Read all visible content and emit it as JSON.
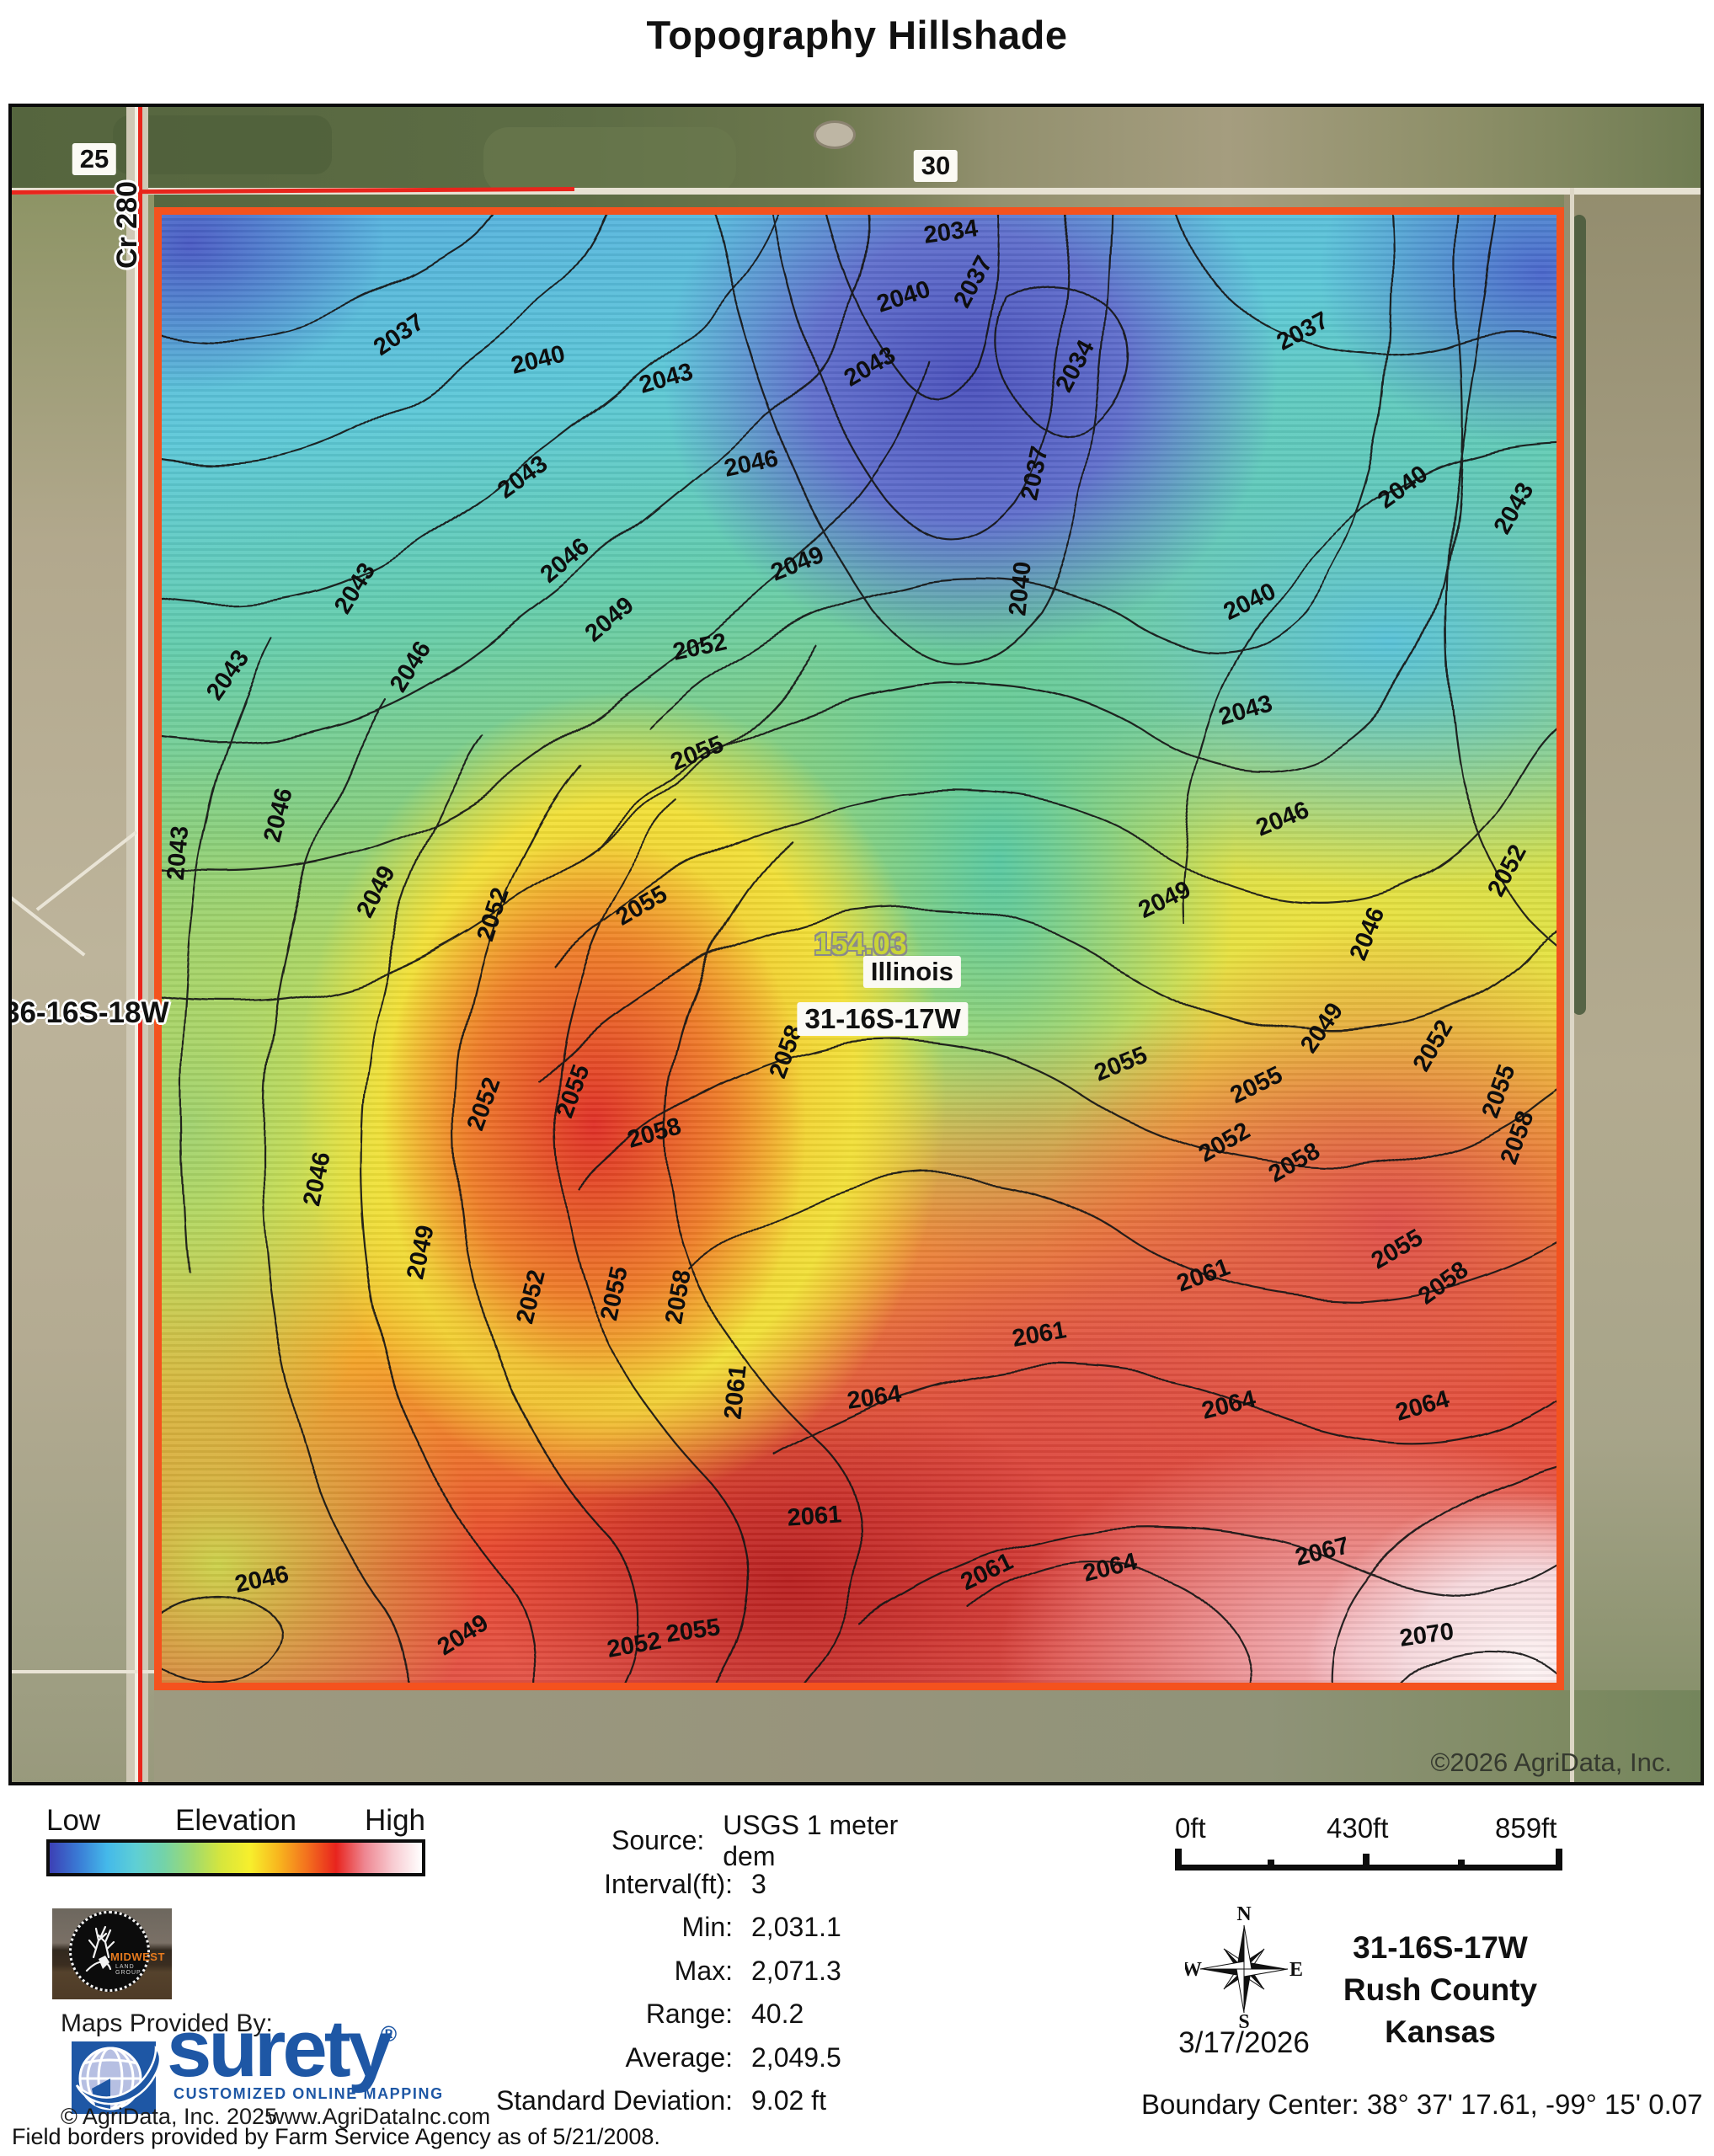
{
  "title": "Topography Hillshade",
  "map": {
    "road_labels": {
      "left_section": "25",
      "top_section": "30",
      "road_name": "Cr 280"
    },
    "section_label_left": "36-16S-18W",
    "parcel": {
      "acreage": "154.03",
      "name": "Illinois",
      "section": "31-16S-17W"
    },
    "copyright": "©2026 AgriData, Inc.",
    "boundary_color": "#f4521e",
    "section_line_color": "#e8251c",
    "contour_labels": [
      {
        "v": "2034",
        "x": 56.6,
        "y": 1.2,
        "r": -8
      },
      {
        "v": "2037",
        "x": 58.2,
        "y": 4.6,
        "r": -62
      },
      {
        "v": "2040",
        "x": 53.2,
        "y": 5.6,
        "r": -18
      },
      {
        "v": "2034",
        "x": 65.5,
        "y": 10.3,
        "r": -62
      },
      {
        "v": "2037",
        "x": 81.8,
        "y": 8.0,
        "r": -28
      },
      {
        "v": "2037",
        "x": 17.0,
        "y": 8.2,
        "r": -34
      },
      {
        "v": "2040",
        "x": 27.0,
        "y": 9.9,
        "r": -14
      },
      {
        "v": "2043",
        "x": 36.2,
        "y": 11.2,
        "r": -16
      },
      {
        "v": "2043",
        "x": 50.8,
        "y": 10.4,
        "r": -30
      },
      {
        "v": "2040",
        "x": 89.0,
        "y": 18.6,
        "r": -36
      },
      {
        "v": "2043",
        "x": 97.0,
        "y": 20.0,
        "r": -60
      },
      {
        "v": "2037",
        "x": 62.6,
        "y": 17.6,
        "r": -78
      },
      {
        "v": "2040",
        "x": 61.6,
        "y": 25.5,
        "r": -84
      },
      {
        "v": "2043",
        "x": 25.9,
        "y": 17.9,
        "r": -36
      },
      {
        "v": "2046",
        "x": 42.3,
        "y": 17.0,
        "r": -12
      },
      {
        "v": "2043",
        "x": 13.9,
        "y": 25.5,
        "r": -58
      },
      {
        "v": "2046",
        "x": 17.9,
        "y": 30.8,
        "r": -58
      },
      {
        "v": "2046",
        "x": 28.9,
        "y": 23.6,
        "r": -40
      },
      {
        "v": "2049",
        "x": 32.1,
        "y": 27.6,
        "r": -40
      },
      {
        "v": "2049",
        "x": 45.6,
        "y": 23.8,
        "r": -22
      },
      {
        "v": "2052",
        "x": 38.6,
        "y": 29.5,
        "r": -12
      },
      {
        "v": "2040",
        "x": 78.0,
        "y": 26.4,
        "r": -26
      },
      {
        "v": "2043",
        "x": 77.7,
        "y": 33.8,
        "r": -16
      },
      {
        "v": "2046",
        "x": 80.4,
        "y": 41.2,
        "r": -22
      },
      {
        "v": "2049",
        "x": 71.9,
        "y": 46.7,
        "r": -26
      },
      {
        "v": "2046",
        "x": 86.5,
        "y": 49.0,
        "r": -68
      },
      {
        "v": "2049",
        "x": 83.2,
        "y": 55.4,
        "r": -55
      },
      {
        "v": "2052",
        "x": 91.2,
        "y": 56.6,
        "r": -60
      },
      {
        "v": "2052",
        "x": 96.5,
        "y": 44.7,
        "r": -62
      },
      {
        "v": "2055",
        "x": 78.5,
        "y": 59.3,
        "r": -26
      },
      {
        "v": "2055",
        "x": 68.8,
        "y": 57.9,
        "r": -22
      },
      {
        "v": "2052",
        "x": 76.2,
        "y": 63.2,
        "r": -30
      },
      {
        "v": "2055",
        "x": 95.9,
        "y": 59.7,
        "r": -70
      },
      {
        "v": "2058",
        "x": 97.2,
        "y": 62.9,
        "r": -70
      },
      {
        "v": "2058",
        "x": 81.2,
        "y": 64.6,
        "r": -30
      },
      {
        "v": "2058",
        "x": 91.9,
        "y": 72.8,
        "r": -36
      },
      {
        "v": "2055",
        "x": 88.6,
        "y": 70.5,
        "r": -30
      },
      {
        "v": "2061",
        "x": 74.7,
        "y": 72.3,
        "r": -20
      },
      {
        "v": "2064",
        "x": 76.5,
        "y": 81.1,
        "r": -14
      },
      {
        "v": "2064",
        "x": 90.4,
        "y": 81.2,
        "r": -16
      },
      {
        "v": "2061",
        "x": 62.9,
        "y": 76.3,
        "r": -10
      },
      {
        "v": "2064",
        "x": 51.1,
        "y": 80.6,
        "r": -8
      },
      {
        "v": "2061",
        "x": 46.8,
        "y": 88.7,
        "r": -4
      },
      {
        "v": "2061",
        "x": 59.2,
        "y": 92.5,
        "r": -26
      },
      {
        "v": "2064",
        "x": 68.0,
        "y": 92.2,
        "r": -14
      },
      {
        "v": "2067",
        "x": 83.2,
        "y": 91.1,
        "r": -14
      },
      {
        "v": "2070",
        "x": 90.7,
        "y": 96.8,
        "r": -8
      },
      {
        "v": "2055",
        "x": 38.1,
        "y": 96.5,
        "r": -8
      },
      {
        "v": "2052",
        "x": 33.9,
        "y": 97.5,
        "r": -10
      },
      {
        "v": "2049",
        "x": 21.6,
        "y": 96.8,
        "r": -32
      },
      {
        "v": "2046",
        "x": 7.2,
        "y": 93.0,
        "r": -12
      },
      {
        "v": "2052",
        "x": 26.5,
        "y": 73.7,
        "r": -76
      },
      {
        "v": "2055",
        "x": 32.5,
        "y": 73.5,
        "r": -78
      },
      {
        "v": "2058",
        "x": 37.1,
        "y": 73.7,
        "r": -80
      },
      {
        "v": "2061",
        "x": 41.2,
        "y": 80.2,
        "r": -84
      },
      {
        "v": "2052",
        "x": 23.8,
        "y": 47.7,
        "r": -72
      },
      {
        "v": "2055",
        "x": 34.4,
        "y": 47.1,
        "r": -30
      },
      {
        "v": "2055",
        "x": 38.4,
        "y": 36.7,
        "r": -22
      },
      {
        "v": "2058",
        "x": 44.8,
        "y": 57.0,
        "r": -70
      },
      {
        "v": "2058",
        "x": 35.3,
        "y": 62.6,
        "r": -16
      },
      {
        "v": "2055",
        "x": 29.5,
        "y": 59.7,
        "r": -70
      },
      {
        "v": "2052",
        "x": 23.1,
        "y": 60.6,
        "r": -70
      },
      {
        "v": "2049",
        "x": 15.4,
        "y": 46.1,
        "r": -62
      },
      {
        "v": "2046",
        "x": 8.4,
        "y": 40.9,
        "r": -76
      },
      {
        "v": "2043",
        "x": 1.2,
        "y": 43.5,
        "r": -85
      },
      {
        "v": "2043",
        "x": 4.8,
        "y": 31.4,
        "r": -55
      },
      {
        "v": "2049",
        "x": 18.6,
        "y": 70.7,
        "r": -78
      },
      {
        "v": "2046",
        "x": 11.2,
        "y": 65.7,
        "r": -78
      }
    ]
  },
  "legend": {
    "low": "Low",
    "title": "Elevation",
    "high": "High",
    "gradient": [
      "#3c40b5",
      "#3a7bd5",
      "#44b9ea",
      "#5ecfd5",
      "#74d3a8",
      "#a0da6e",
      "#d7e63c",
      "#f7ef2c",
      "#f8b51e",
      "#f3701e",
      "#e8241e",
      "#ee8691",
      "#f8ccd2",
      "#ffffff"
    ]
  },
  "stats": {
    "rows": [
      {
        "label": "Source:",
        "value": "USGS 1 meter dem"
      },
      {
        "label": "Interval(ft):",
        "value": "3"
      },
      {
        "label": "Min:",
        "value": "2,031.1"
      },
      {
        "label": "Max:",
        "value": "2,071.3"
      },
      {
        "label": "Range:",
        "value": "40.2"
      },
      {
        "label": "Average:",
        "value": "2,049.5"
      },
      {
        "label": "Standard Deviation:",
        "value": "9.02 ft"
      }
    ]
  },
  "scalebar": {
    "labels": [
      "0ft",
      "430ft",
      "859ft"
    ]
  },
  "compass": {
    "n": "N",
    "e": "E",
    "s": "S",
    "w": "W",
    "date": "3/17/2026"
  },
  "location": {
    "section": "31-16S-17W",
    "county": "Rush County",
    "state": "Kansas"
  },
  "boundary_center": "Boundary Center: 38° 37' 17.61,  -99° 15' 0.07",
  "provider": {
    "maps_provided_by": "Maps Provided By:",
    "brand": "surety",
    "registered": "®",
    "tagline": "CUSTOMIZED ONLINE MAPPING",
    "midwest": "MIDWEST",
    "midwest_sub": "LAND GROUP",
    "copyright": "© AgriData, Inc. 2025",
    "website": "www.AgriDataInc.com",
    "brand_color": "#1e57a5"
  },
  "footnote": "Field borders provided by Farm Service Agency as of 5/21/2008."
}
